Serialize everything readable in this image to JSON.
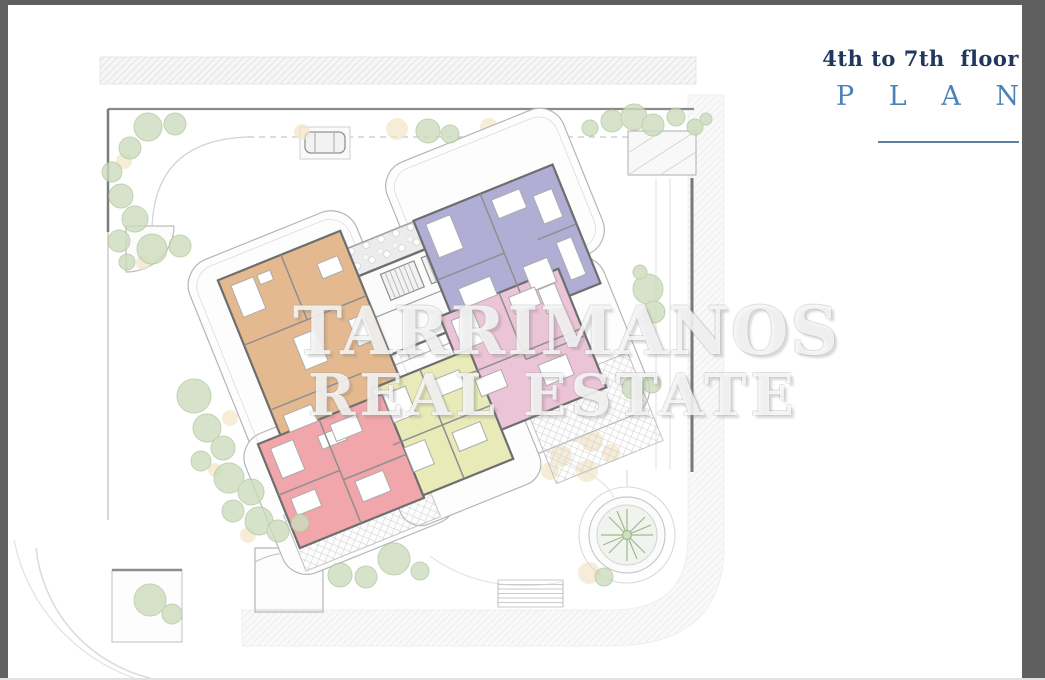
{
  "page": {
    "kind": "real-estate floor plan image",
    "title_line1": "4th to 7th  floor",
    "title_line2": "P L A N",
    "title_color": "#22375d",
    "plan_color": "#4b83b9",
    "rule_color": "#5d7fa0"
  },
  "watermark": {
    "line1": "TARRIMANOS",
    "line2": "REAL ESTATE"
  },
  "frame": {
    "border_color": "#5f5f5f"
  },
  "floor_plan": {
    "description": "Rotated residential building footprint on landscaped corner plot with roads on top and right, parking, garden, palm court",
    "units": [
      {
        "name": "unit-orange",
        "color": "#e5b98f"
      },
      {
        "name": "unit-purple",
        "color": "#b1aed6"
      },
      {
        "name": "unit-pink",
        "color": "#ecc4d7"
      },
      {
        "name": "unit-yellow",
        "color": "#e8eab8"
      },
      {
        "name": "unit-red",
        "color": "#f0a6aa"
      }
    ],
    "core_color": "#fbfbfb",
    "wall_color": "#6e6e6e",
    "landscape": {
      "tree_color": "#ccdcbc",
      "tree_stroke": "#b2c7a0",
      "shrub_color": "#f4e4c6",
      "palm_color": "#9fb98c"
    },
    "icons": {
      "tree": "tree-canopy-icon",
      "shrub": "shrub-icon",
      "palm": "palm-tree-icon",
      "car": "car-icon",
      "stairs": "stairs-icon"
    }
  }
}
